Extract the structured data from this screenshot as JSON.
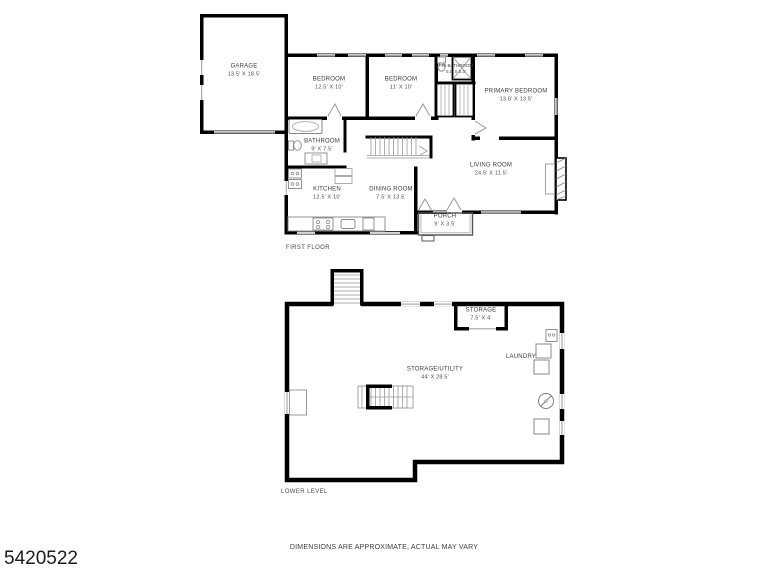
{
  "first_floor": {
    "title": "FIRST FLOOR",
    "rooms": [
      {
        "name": "GARAGE",
        "dims": "13.5' X 18.5'"
      },
      {
        "name": "BEDROOM",
        "dims": "12.5' X 10'"
      },
      {
        "name": "BEDROOM",
        "dims": "11' X 10'"
      },
      {
        "name": "PRI BATHROOM",
        "dims": "5.5' X 5.5'"
      },
      {
        "name": "PRIMARY BEDROOM",
        "dims": "13.0' X 13.5'"
      },
      {
        "name": "BATHROOM",
        "dims": "9' X 7.5'"
      },
      {
        "name": "LIVING ROOM",
        "dims": "24.5' X 11.5'"
      },
      {
        "name": "KITCHEN",
        "dims": "12.5' X 10'"
      },
      {
        "name": "DINING ROOM",
        "dims": "7.5' X 13.5'"
      },
      {
        "name": "PORCH",
        "dims": "9' X 3.5'"
      }
    ]
  },
  "lower_level": {
    "title": "LOWER LEVEL",
    "rooms": [
      {
        "name": "STORAGE",
        "dims": "7.5' X 4'"
      },
      {
        "name": "LAUNDRY",
        "dims": ""
      },
      {
        "name": "STORAGE/UTILITY",
        "dims": "44' X 28.5'"
      }
    ]
  },
  "footer": {
    "listing_id": "5420522",
    "disclaimer": "DIMENSIONS ARE APPROXIMATE, ACTUAL MAY VARY"
  },
  "colors": {
    "walls": "#000000",
    "fixtures": "#8a8a8a",
    "windows": "#9a9a9a",
    "background": "#ffffff"
  }
}
